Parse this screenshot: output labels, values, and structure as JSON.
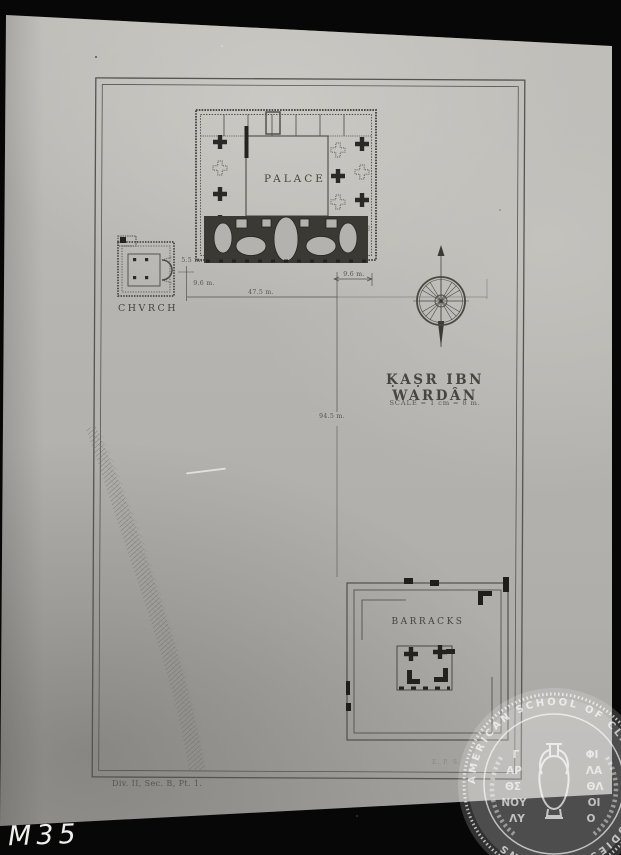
{
  "photo": {
    "handwritten_label": "M35"
  },
  "plate": {
    "title": "ḲAṢR IBN WARDÂN",
    "scale_note": "SCALE = 1 cm = 8 m.",
    "reference": "Div. II, Sec. B, Pt. 1.",
    "credit_marks": "E. P. S.",
    "labels": {
      "palace": "PALACE",
      "church": "CHVRCH",
      "barracks": "BARRACKS"
    },
    "dimensions": {
      "church_to_palace": "5.5 m.",
      "southwest_offset": "9.6 m.",
      "palace_south_front": "47.5 m.",
      "southeast_offset": "9.6 m.",
      "palace_to_barracks": "94.5 m."
    }
  },
  "watermark": {
    "ring_text": "AMERICAN SCHOOL OF CLASSICAL STUDIES AT ATHENS",
    "greek_left": [
      "Γ",
      "ΑΡ",
      "ΘΣ",
      "ΝΟΥ",
      "ΛΥ"
    ],
    "greek_right": [
      "ΦΙ",
      "ΛΑ",
      "ΘΛ",
      "ΟΙ",
      "Ο"
    ]
  },
  "colors": {
    "plate_black": "#070707",
    "paper_gray": "#b4b2ae",
    "ink": "#45433e",
    "seal_white": "#ffffff"
  }
}
